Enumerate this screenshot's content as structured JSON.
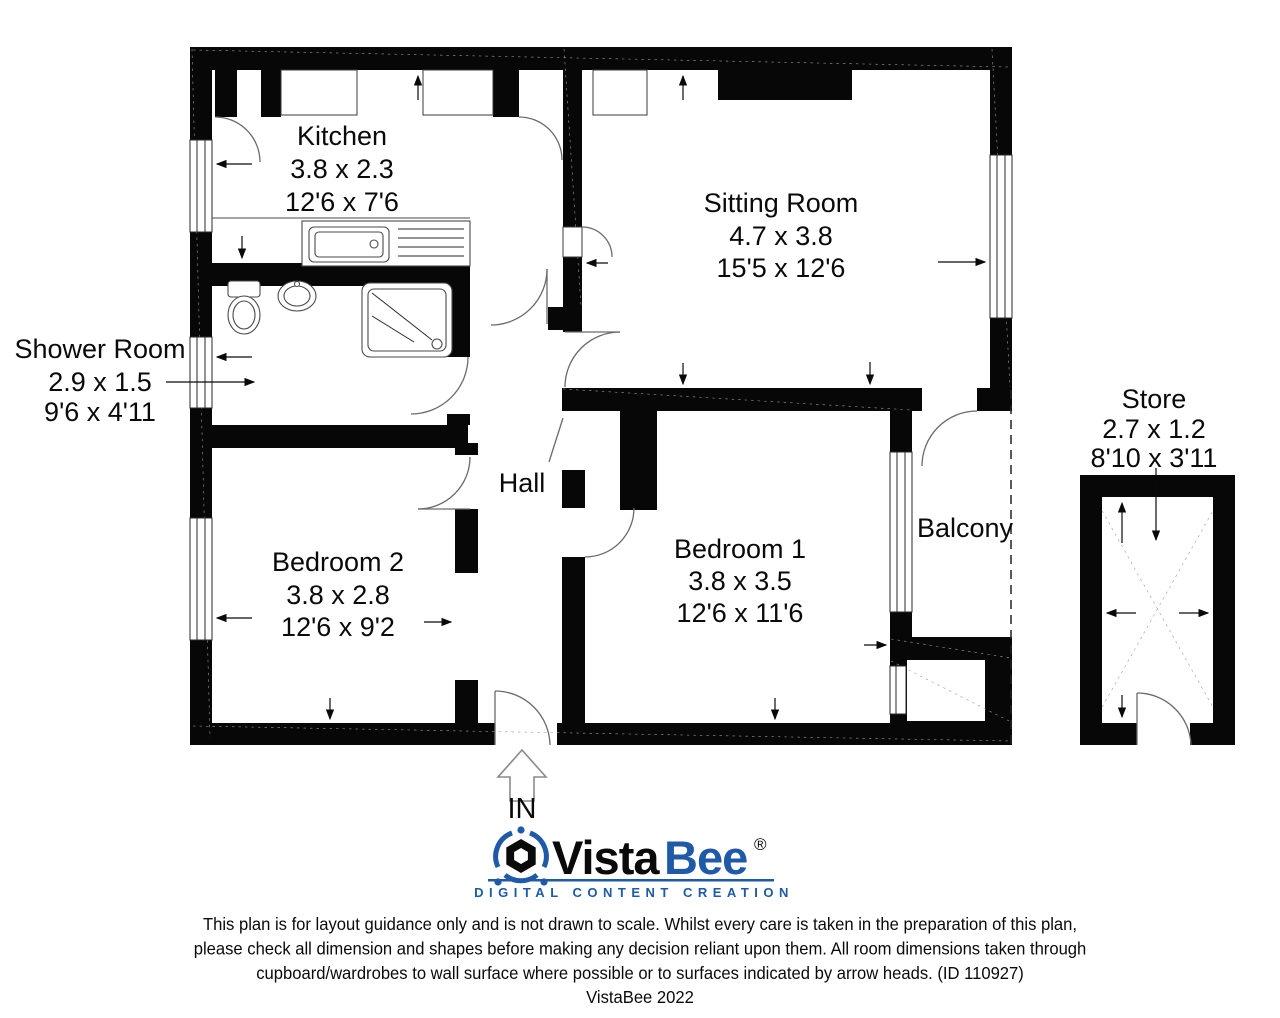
{
  "plan": {
    "rooms": {
      "kitchen": {
        "name": "Kitchen",
        "metric": "3.8 x 2.3",
        "imperial": "12'6 x 7'6"
      },
      "sitting": {
        "name": "Sitting Room",
        "metric": "4.7 x 3.8",
        "imperial": "15'5 x 12'6"
      },
      "shower": {
        "name": "Shower Room",
        "metric": "2.9 x 1.5",
        "imperial": "9'6 x 4'11"
      },
      "bedroom2": {
        "name": "Bedroom 2",
        "metric": "3.8 x 2.8",
        "imperial": "12'6 x 9'2"
      },
      "bedroom1": {
        "name": "Bedroom 1",
        "metric": "3.8 x 3.5",
        "imperial": "12'6 x 11'6"
      },
      "hall": {
        "name": "Hall"
      },
      "balcony": {
        "name": "Balcony"
      },
      "store": {
        "name": "Store",
        "metric": "2.7 x 1.2",
        "imperial": "8'10 x 3'11"
      }
    },
    "entrance_label": "IN"
  },
  "branding": {
    "wordmark_part1": "Vista",
    "wordmark_part2": "Bee",
    "registered_mark": "®",
    "tagline": "DIGITAL CONTENT CREATION",
    "brand_blue": "#1e5aa8"
  },
  "disclaimer": {
    "line1": "This plan is for layout guidance only and is not drawn to scale. Whilst every care is taken in the preparation of this plan,",
    "line2": "please check all dimension and shapes before making any decision reliant upon them. All room dimensions taken through",
    "line3": "cupboard/wardrobes to wall surface where possible or to surfaces indicated by arrow heads. (ID 110927)",
    "line4": "VistaBee 2022"
  }
}
